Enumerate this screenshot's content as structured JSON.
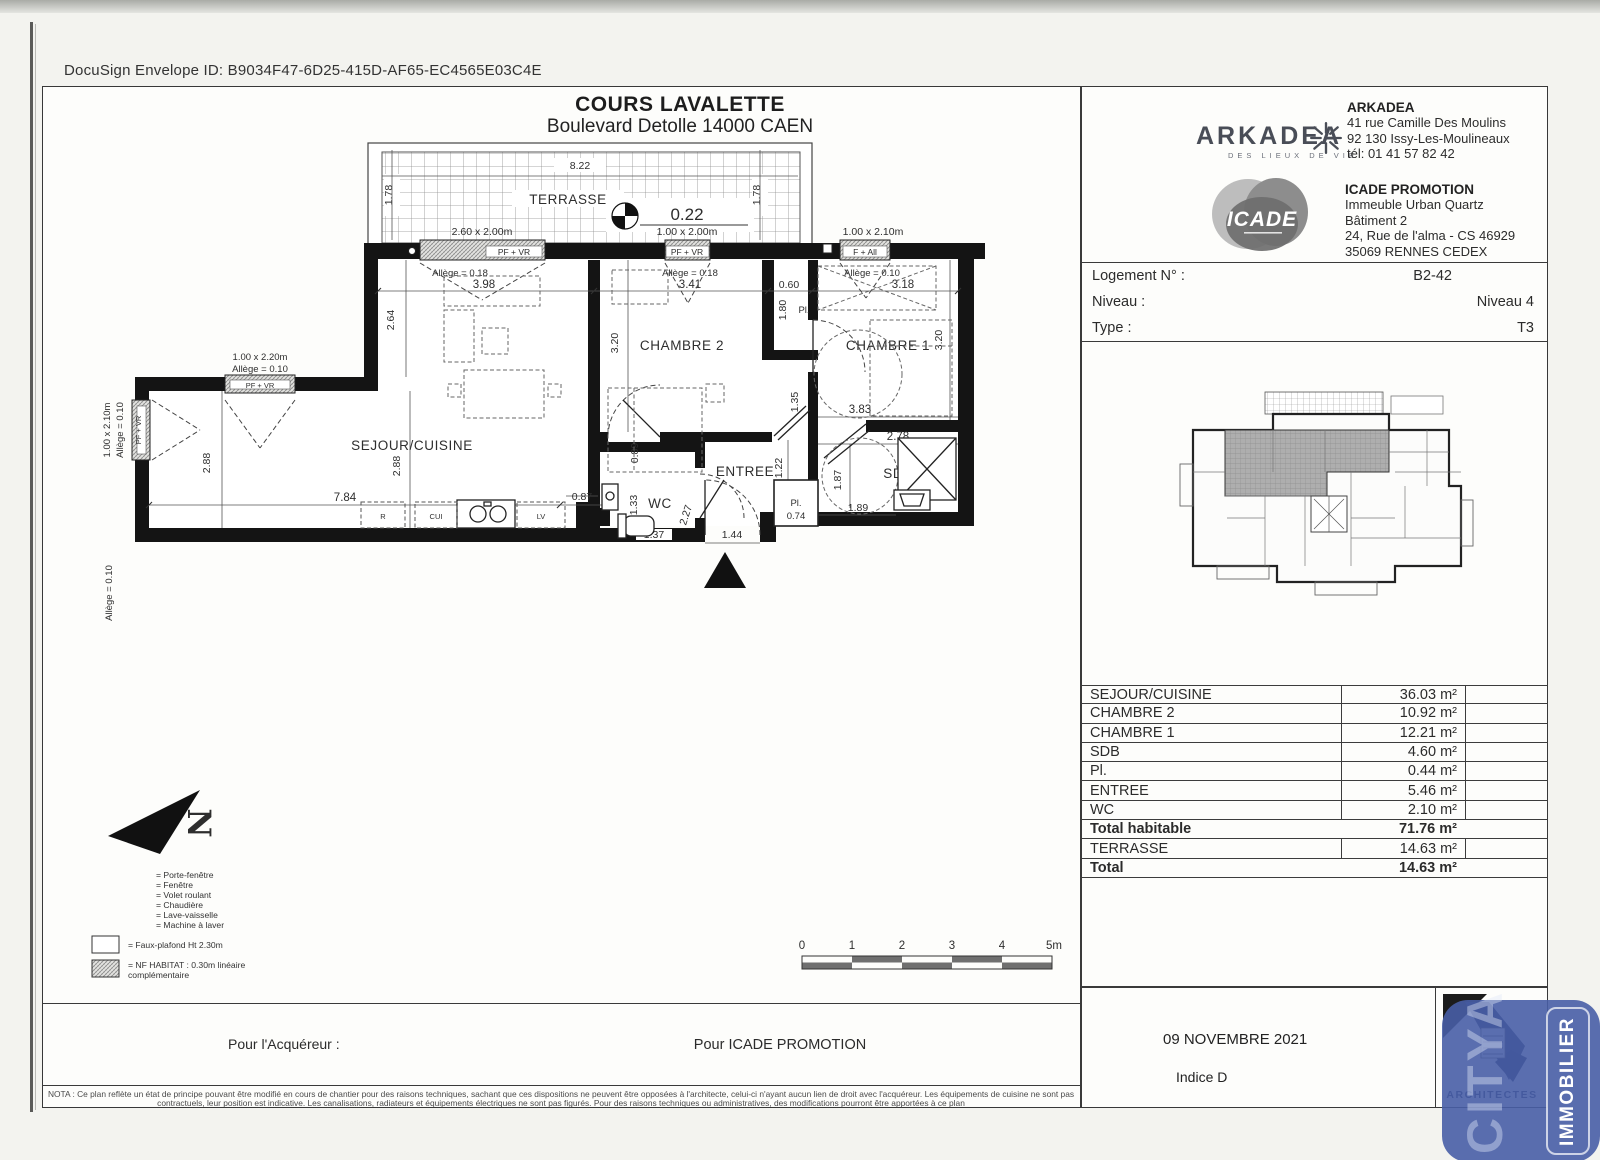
{
  "page": {
    "docusign": "DocuSign Envelope ID: B9034F47-6D25-415D-AF65-EC4565E03C4E",
    "title": "COURS LAVALETTE",
    "subtitle": "Boulevard Detolle 14000 CAEN"
  },
  "plan": {
    "rooms": {
      "terrasse": "TERRASSE",
      "sejour": "SEJOUR/CUISINE",
      "chambre2": "CHAMBRE 2",
      "chambre1": "CHAMBRE 1",
      "entree": "ENTREE",
      "wc": "WC",
      "sdb": "SDB",
      "pl_small": "Pl.",
      "pl_hall": "Pl."
    },
    "level": "0.22",
    "north": "N",
    "windows": {
      "w1": {
        "size": "2.60 x 2.00m",
        "type": "PF + VR",
        "allege": "Allège = 0.18"
      },
      "w2": {
        "size": "1.00 x 2.00m",
        "type": "PF + VR",
        "allege": "Allège = 0.18"
      },
      "w3": {
        "size": "1.00 x 2.10m",
        "type": "F + All",
        "allege": "Allège = 0.10"
      },
      "w4": {
        "size": "1.00 x 2.20m",
        "type": "PF + VR",
        "allege": "Allège = 0.10"
      },
      "w5": {
        "size": "1.00 x 2.10m",
        "type": "PF + VR",
        "allege": "Allège = 0.10"
      },
      "allege_left": "Allège = 0.10"
    },
    "dims": {
      "d822": "8.22",
      "d178l": "1.78",
      "d178r": "1.78",
      "d398": "3.98",
      "d341": "3.41",
      "d060": "0.60",
      "d318": "3.18",
      "d264": "2.64",
      "d288a": "2.88",
      "d288b": "2.88",
      "d784": "7.84",
      "d087": "0.87",
      "d089": "0.89",
      "d320a": "3.20",
      "d320b": "3.20",
      "d180": "1.80",
      "d135": "1.35",
      "d383": "3.83",
      "d278": "2.78",
      "d187": "1.87",
      "d189": "1.89",
      "d074": "0.74",
      "d122": "1.22",
      "d227": "2.27",
      "d144": "1.44",
      "d137": "1.37",
      "d133": "1.33"
    },
    "kitchen": {
      "r": "R",
      "cui": "CUI",
      "lv": "LV"
    }
  },
  "legend": {
    "items": [
      "= Porte-fenêtre",
      "= Fenêtre",
      "= Volet roulant",
      "= Chaudière",
      "= Lave-vaisselle",
      "= Machine à laver"
    ],
    "faux_plafond": "= Faux-plafond Ht 2.30m",
    "nf_1": "= NF HABITAT : 0.30m linéaire",
    "nf_2": "complémentaire"
  },
  "scalebar": {
    "labels": [
      "0",
      "1",
      "2",
      "3",
      "4",
      "5m"
    ]
  },
  "sidebar": {
    "arkadea": {
      "logo": "ARKADEA",
      "tagline": "DES LIEUX DE VIE",
      "title": "ARKADEA",
      "lines": [
        "41 rue Camille Des Moulins",
        "92 130 Issy-Les-Moulineaux",
        "tél: 01 41 57 82 42"
      ]
    },
    "icade": {
      "logo": "ICADE",
      "title": "ICADE PROMOTION",
      "lines": [
        "Immeuble Urban Quartz",
        "Bâtiment 2",
        "24, Rue de l'alma - CS 46929",
        "35069 RENNES CEDEX"
      ]
    },
    "unit": [
      {
        "label": "Logement N° :",
        "value": "B2-42"
      },
      {
        "label": "Niveau :",
        "value": "Niveau 4"
      },
      {
        "label": "Type :",
        "value": "T3"
      }
    ],
    "areas": [
      {
        "label": "SEJOUR/CUISINE",
        "value": "36.03 m²"
      },
      {
        "label": "CHAMBRE 2",
        "value": "10.92 m²"
      },
      {
        "label": "CHAMBRE 1",
        "value": "12.21 m²"
      },
      {
        "label": "SDB",
        "value": "4.60 m²"
      },
      {
        "label": "Pl.",
        "value": "0.44 m²"
      },
      {
        "label": "ENTREE",
        "value": "5.46 m²"
      },
      {
        "label": "WC",
        "value": "2.10 m²"
      },
      {
        "label": "Total habitable",
        "value": "71.76 m²"
      },
      {
        "label": "TERRASSE",
        "value": "14.63 m²"
      },
      {
        "label": "Total",
        "value": "14.63 m²"
      }
    ],
    "date": "09 NOVEMBRE 2021",
    "indice": "Indice D",
    "architectes": "ARCHITECTES",
    "citya": "CITYA",
    "immobilier": "IMMOBILIER"
  },
  "footer": {
    "acquereur": "Pour l'Acquéreur :",
    "pour_icade": "Pour ICADE PROMOTION",
    "nota_1": "NOTA : Ce plan reflète un état de principe pouvant être modifié en cours de chantier pour des raisons techniques, sachant que ces dispositions ne peuvent être opposées à l'architecte, celui-ci n'ayant aucun lien de droit avec l'acquéreur. Les équipements de cuisine ne sont pas",
    "nota_2": "contractuels, leur position est indicative. Les canalisations, radiateurs et équipements électriques ne sont pas figurés. Pour des raisons techniques ou administratives, des modifications pourront être apportées à ce plan"
  }
}
